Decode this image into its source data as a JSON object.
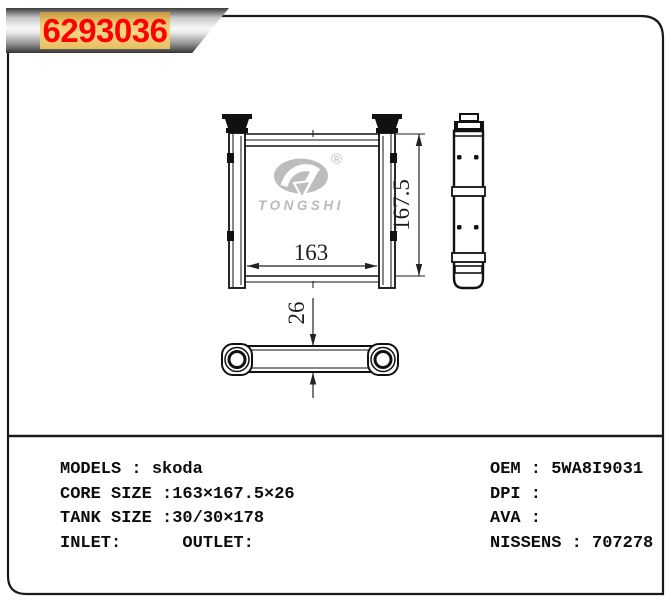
{
  "banner": {
    "part_number": "6293036"
  },
  "logo": {
    "brand": "TONGSHI",
    "registered": "®"
  },
  "drawing": {
    "width_dim": "163",
    "height_dim": "167.5",
    "depth_dim": "26"
  },
  "specs": {
    "models": "MODELS : skoda",
    "core_size": "CORE SIZE :163×167.5×26",
    "tank_size": "TANK SIZE :30/30×178",
    "inlet_outlet": "INLET:      OUTLET:",
    "oem": "OEM : 5WA8I9031",
    "dpi": "DPI :",
    "ava": "AVA :",
    "nissens": "NISSENS : 707278"
  },
  "colors": {
    "part_number_red": "#ff0000",
    "plate_gold": "#eec96e",
    "watermark_gray": "#bdbdbd",
    "line_black": "#111111"
  }
}
